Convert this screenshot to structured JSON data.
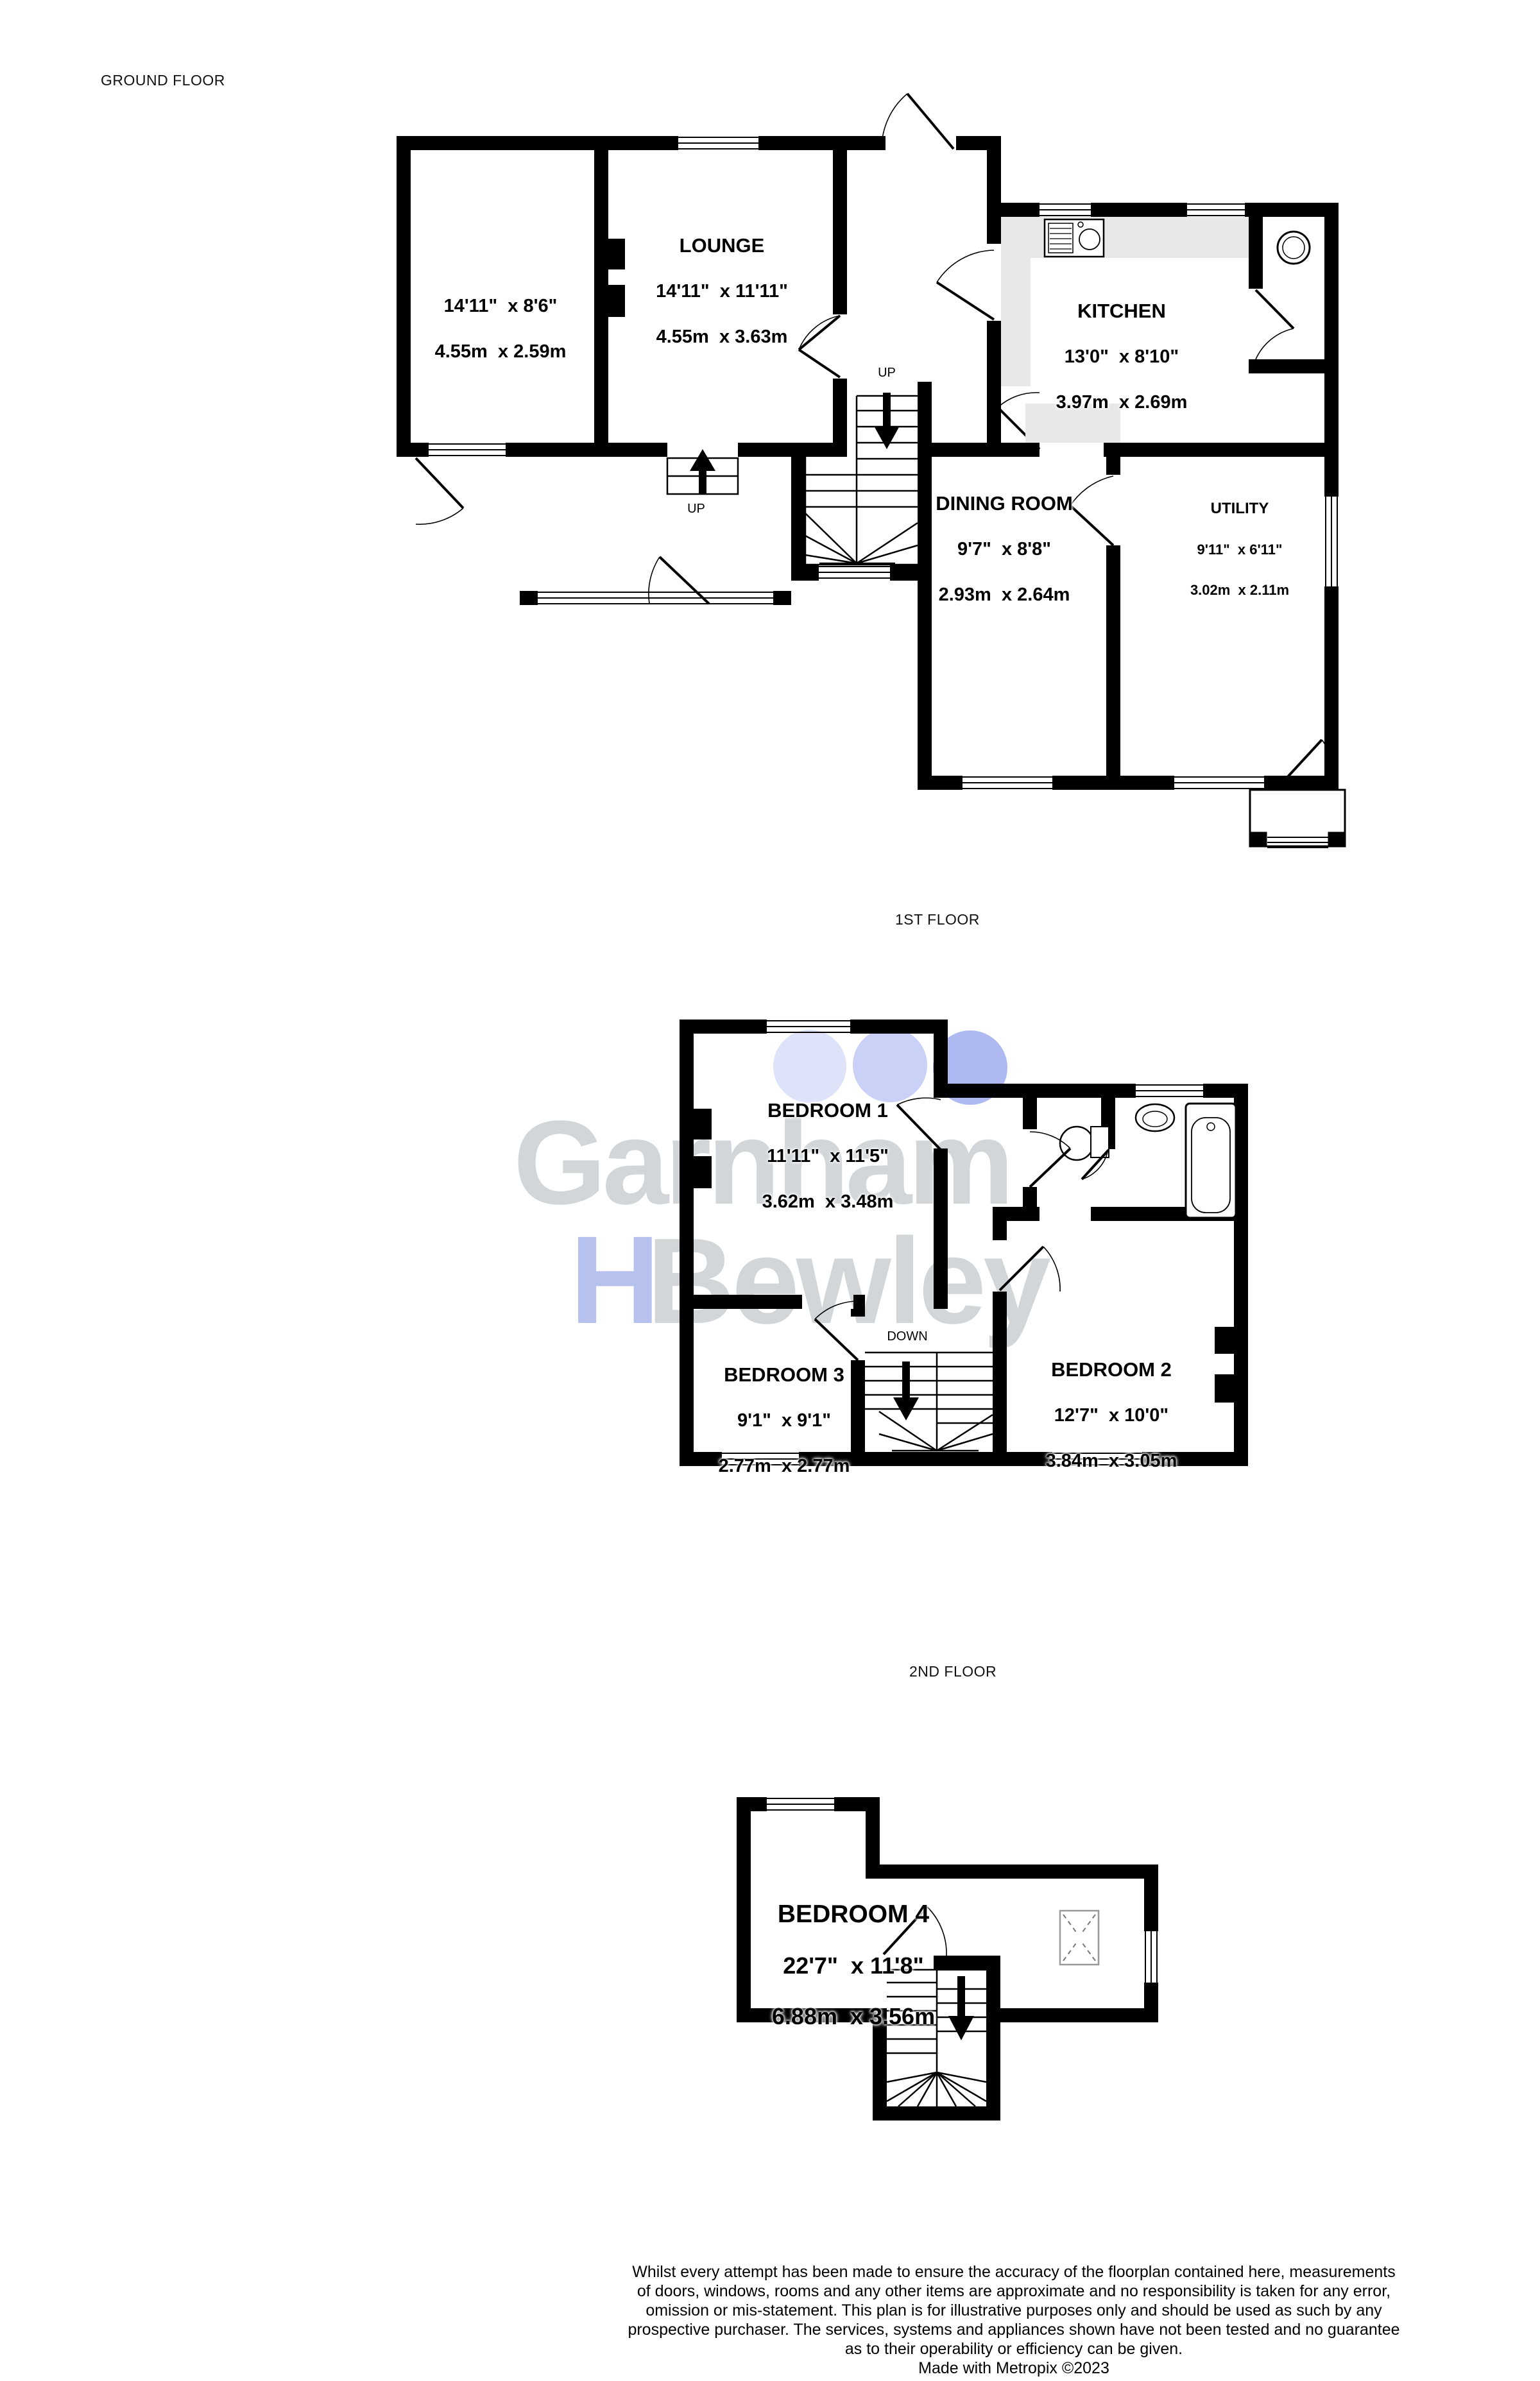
{
  "floors": {
    "ground": {
      "title": "GROUND FLOOR",
      "rooms": {
        "reception": {
          "imperial": "14'11\"  x 8'6\"",
          "metric": "4.55m  x 2.59m"
        },
        "lounge": {
          "name": "LOUNGE",
          "imperial": "14'11\"  x 11'11\"",
          "metric": "4.55m  x 3.63m"
        },
        "kitchen": {
          "name": "KITCHEN",
          "imperial": "13'0\"  x 8'10\"",
          "metric": "3.97m  x 2.69m"
        },
        "dining": {
          "name": "DINING ROOM",
          "imperial": "9'7\"  x 8'8\"",
          "metric": "2.93m  x 2.64m"
        },
        "utility": {
          "name": "UTILITY",
          "imperial": "9'11\"  x 6'11\"",
          "metric": "3.02m  x 2.11m"
        }
      }
    },
    "first": {
      "title": "1ST FLOOR",
      "rooms": {
        "bedroom1": {
          "name": "BEDROOM 1",
          "imperial": "11'11\"  x 11'5\"",
          "metric": "3.62m  x 3.48m"
        },
        "bedroom2": {
          "name": "BEDROOM 2",
          "imperial": "12'7\"  x 10'0\"",
          "metric": "3.84m  x 3.05m"
        },
        "bedroom3": {
          "name": "BEDROOM 3",
          "imperial": "9'1\"  x 9'1\"",
          "metric": "2.77m  x 2.77m"
        }
      }
    },
    "second": {
      "title": "2ND FLOOR",
      "rooms": {
        "bedroom4": {
          "name": "BEDROOM 4",
          "imperial": "22'7\"  x 11'8\"",
          "metric": "6.88m  x 3.56m"
        }
      }
    }
  },
  "stairs": {
    "up": "UP",
    "down": "DOWN"
  },
  "watermark": {
    "word1": "Garnham",
    "word2": "H",
    "word3": "Bewley"
  },
  "disclaimer": [
    "Whilst every attempt has been made to ensure the accuracy of the floorplan contained here, measurements",
    "of doors, windows, rooms and any other items are approximate and no responsibility is taken for any error,",
    "omission or mis-statement. This plan is for illustrative purposes only and should be used as such by any",
    "prospective purchaser. The services, systems and appliances shown have not been tested and no guarantee",
    "as to their operability or efficiency can be given.",
    "Made with Metropix ©2023"
  ],
  "colors": {
    "wall": "#000000",
    "counter": "#e8e8e8",
    "watermark_gray": "#d2d6d9",
    "watermark_blue": "#b7c1ee",
    "logo_circle_1": "#dfe3fa",
    "logo_circle_2": "#c9d1f7",
    "logo_circle_3": "#aeb9f1"
  }
}
